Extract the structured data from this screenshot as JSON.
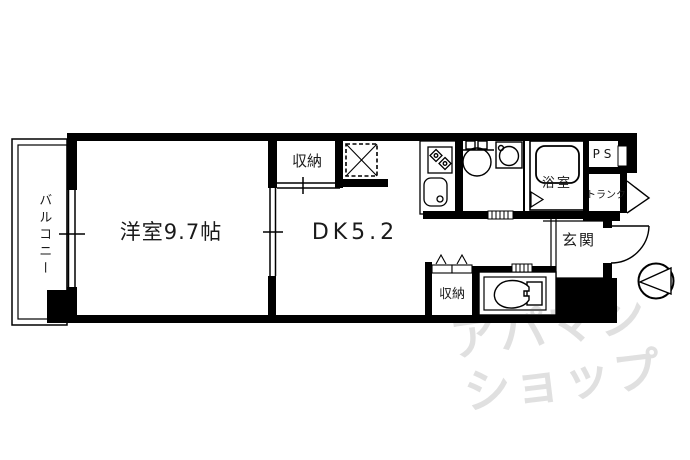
{
  "floorplan": {
    "type": "1DK apartment floor plan",
    "rooms": {
      "balcony": "バルコニー",
      "western_room": "洋室9.7帖",
      "dining_kitchen": "DK5.2",
      "closet_top": "収納",
      "closet_bottom": "収納",
      "bathroom": "浴室",
      "entrance": "玄関",
      "trunk": "トランク",
      "pipe_space": "PS"
    },
    "watermark": {
      "line1": "アパマン",
      "line2": "ショップ"
    },
    "icons": {
      "stove-icon": "two-burner gas stove (diamonds)",
      "kitchen-sink-icon": "rounded rectangle with drain circle",
      "washbasin-icon": "round bowl with taps",
      "washing-machine-icon": "square with circle",
      "bathtub-icon": "rounded rectangle tub",
      "toilet-icon": "bowl with tank",
      "refrigerator-space-icon": "dashed square with X",
      "entrance-marker-icon": "circle with triangle",
      "door-arc-icon": "quarter-circle swing",
      "window-icon": "double line with tick"
    },
    "colors": {
      "wall": "#000000",
      "background": "#ffffff",
      "watermark": "#e0e0e0"
    }
  }
}
